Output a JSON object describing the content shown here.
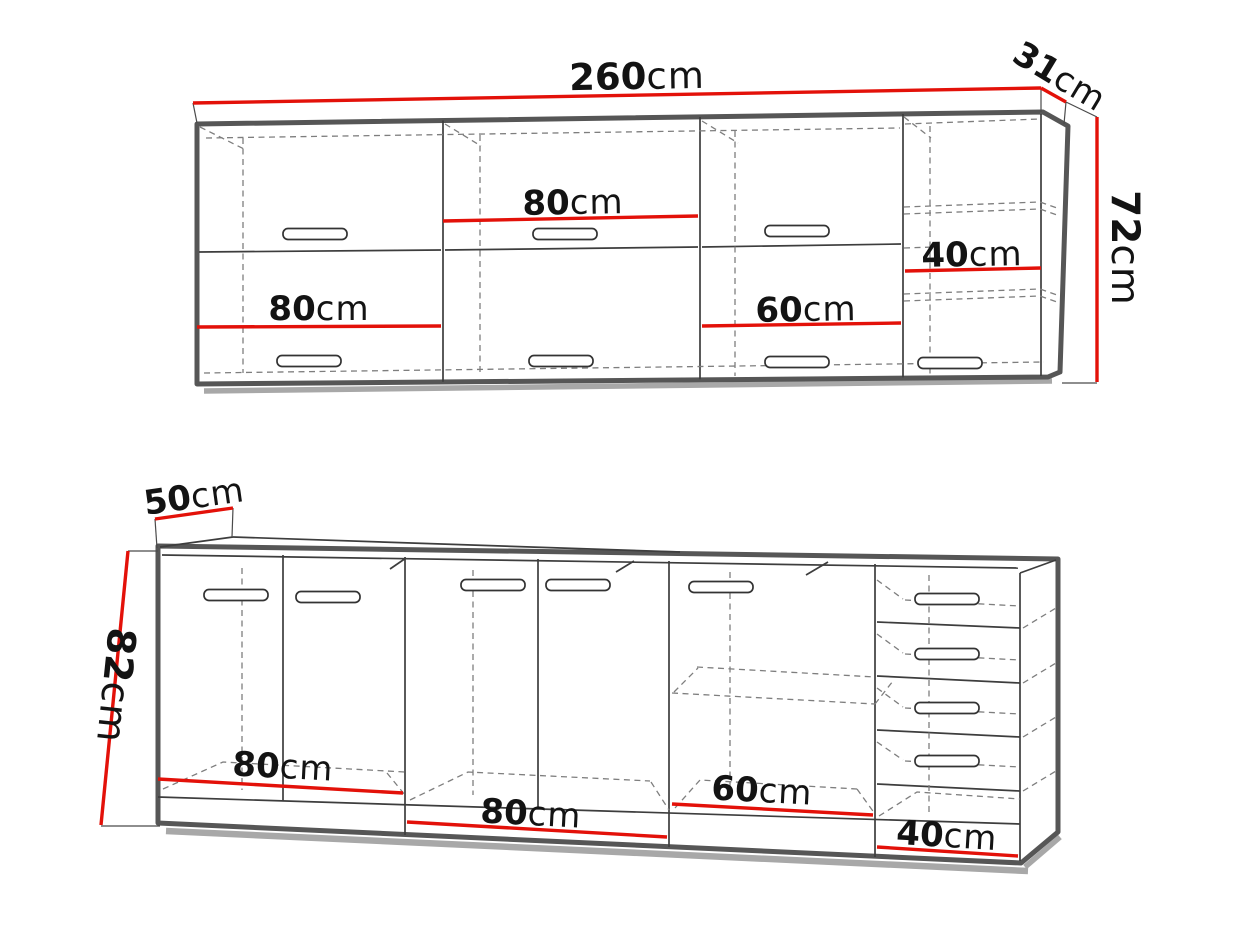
{
  "palette": {
    "background": "#ffffff",
    "dimension_line_red": "#e31109",
    "cabinet_outline_gray": "#565656",
    "thin_line": "#3d3d3d",
    "dashed_line": "#7e7e7e",
    "shadow_gray": "#a8a8a8",
    "text_color": "#131313"
  },
  "wall_unit": {
    "total_width": {
      "number": "260",
      "unit": "cm"
    },
    "depth": {
      "number": "31",
      "unit": "cm"
    },
    "height": {
      "number": "72",
      "unit": "cm"
    },
    "sections": [
      {
        "number": "80",
        "unit": "cm"
      },
      {
        "number": "80",
        "unit": "cm"
      },
      {
        "number": "60",
        "unit": "cm"
      },
      {
        "number": "40",
        "unit": "cm"
      }
    ]
  },
  "base_unit": {
    "depth": {
      "number": "50",
      "unit": "cm"
    },
    "height": {
      "number": "82",
      "unit": "cm"
    },
    "sections": [
      {
        "number": "80",
        "unit": "cm"
      },
      {
        "number": "80",
        "unit": "cm"
      },
      {
        "number": "60",
        "unit": "cm"
      },
      {
        "number": "40",
        "unit": "cm"
      }
    ]
  }
}
